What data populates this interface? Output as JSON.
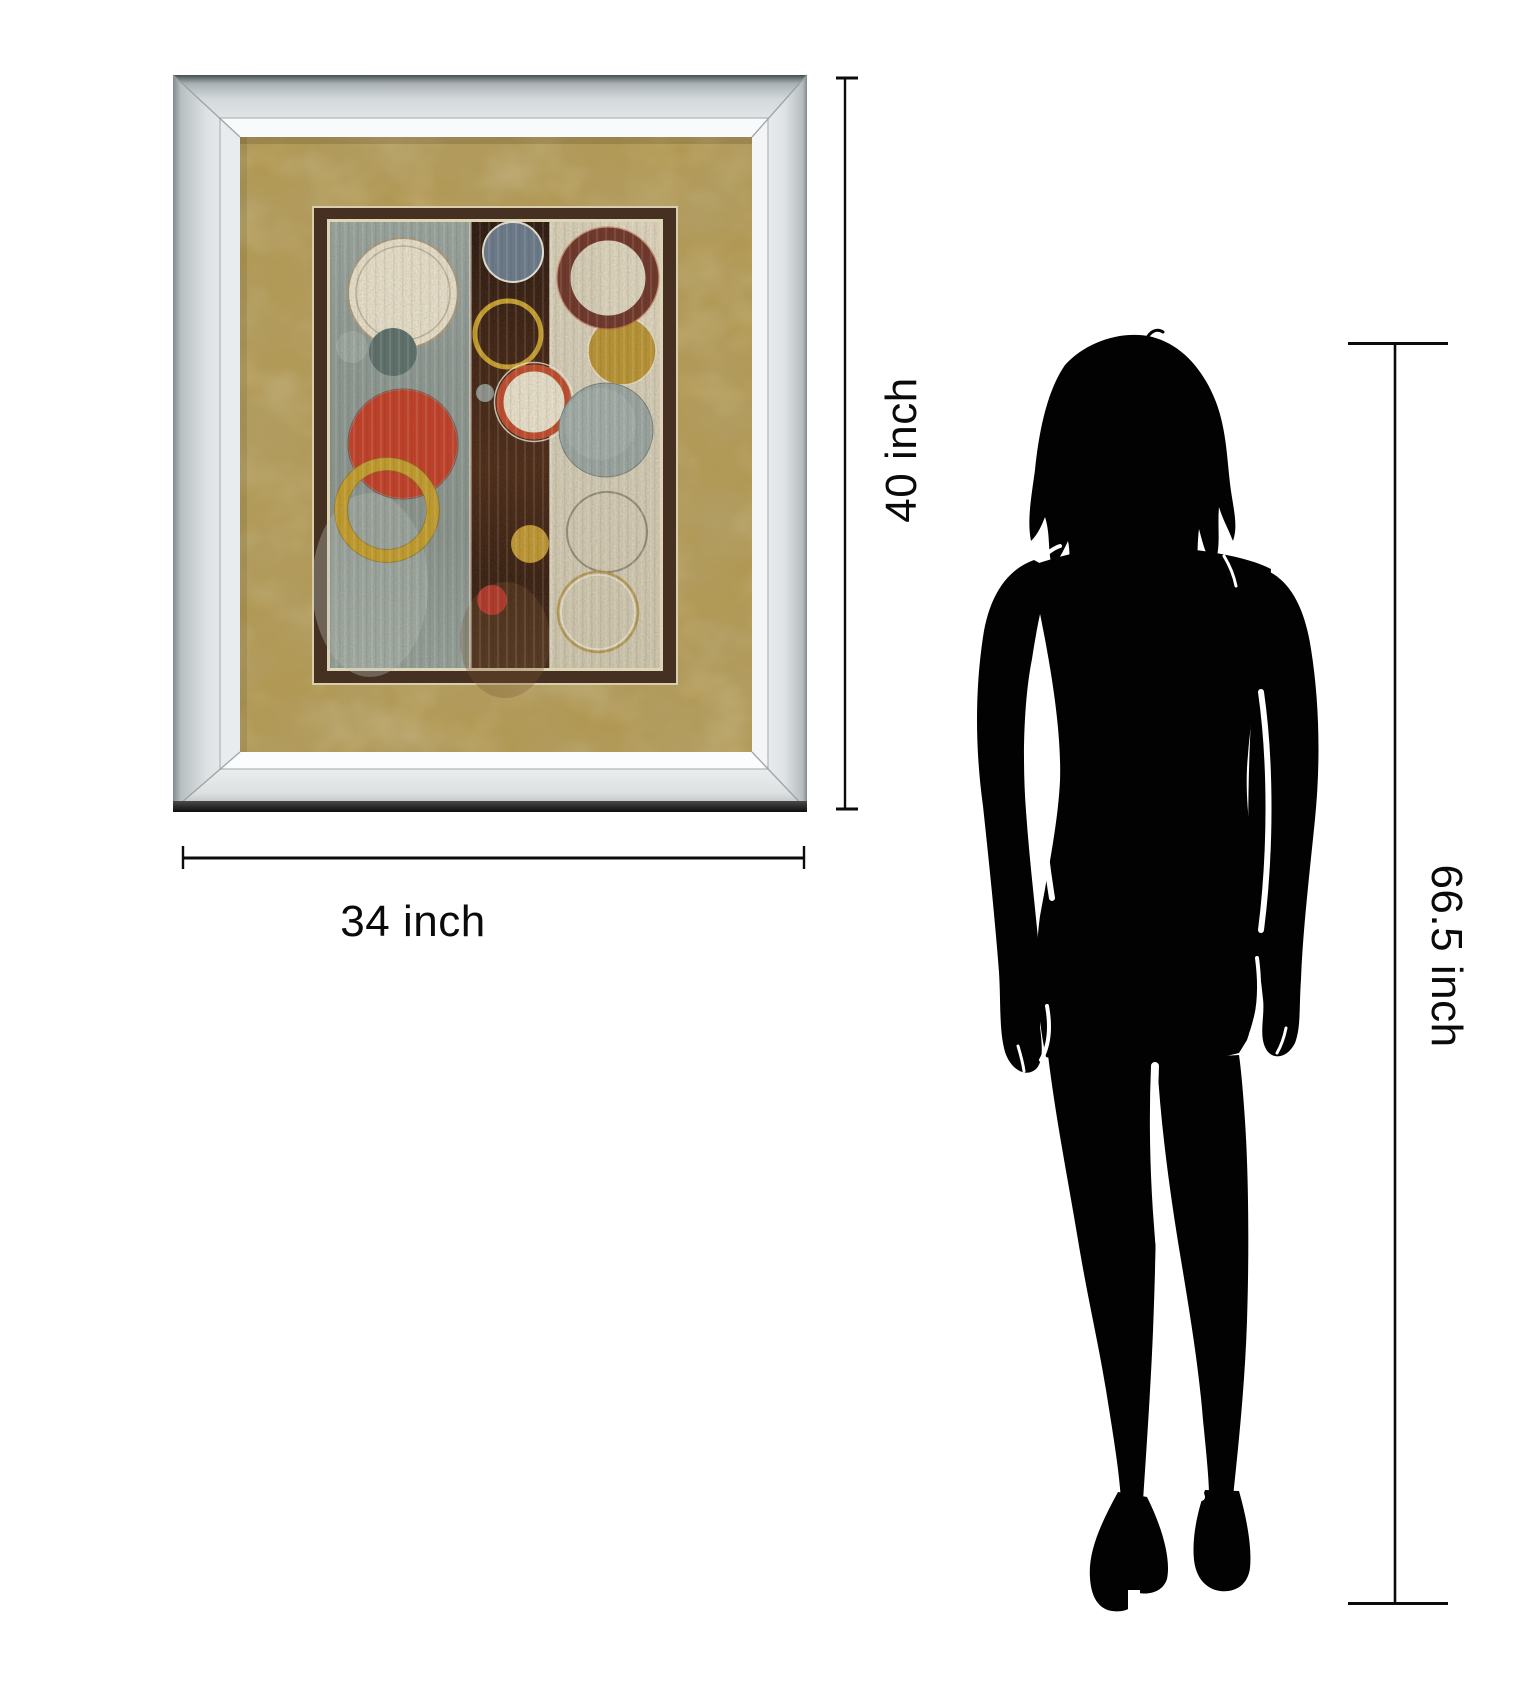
{
  "canvas": {
    "width": 1536,
    "height": 1688,
    "background": "#ffffff"
  },
  "annotations": {
    "artwork_height": {
      "label": "40 inch"
    },
    "artwork_width": {
      "label": "34 inch"
    },
    "figure_height": {
      "label": "66.5 inch"
    },
    "line_color": "#0b0b0b",
    "text_color": "#0a0a0a"
  },
  "framed_art": {
    "frame": {
      "style": "mirrored-bevel-silver",
      "face_color": "#e9ecee",
      "edge_dark": "#454d50"
    },
    "mat": {
      "color": "#b19854",
      "texture": "suede-mottled"
    },
    "inner_mat": {
      "color": "#463021",
      "liner_color": "#ded4b6"
    },
    "painting": {
      "style": "abstract-circles-triptych-bands",
      "bands": [
        {
          "name": "left-band",
          "color": "#8f9a94"
        },
        {
          "name": "middle-band",
          "color": "#3c2213"
        },
        {
          "name": "right-band",
          "color": "#d5cdb6"
        }
      ],
      "circles": [
        {
          "name": "ivory-circle-large",
          "cx": 403,
          "cy": 293,
          "r": 55,
          "fill": "#e7dfc9",
          "stroke": "#a99a7e",
          "sw": 2
        },
        {
          "name": "ivory-circle-inner-line",
          "cx": 403,
          "cy": 293,
          "r": 47,
          "fill": "none",
          "stroke": "#b6a78b",
          "sw": 1.5,
          "op": 0.8
        },
        {
          "name": "faint-gray-circle",
          "cx": 352,
          "cy": 347,
          "r": 16,
          "fill": "#a9b3ac",
          "op": 0.55
        },
        {
          "name": "slate-circle",
          "cx": 393,
          "cy": 352,
          "r": 24,
          "fill": "#5d706c"
        },
        {
          "name": "red-circle-large",
          "cx": 403,
          "cy": 444,
          "r": 54,
          "fill": "#c33f27"
        },
        {
          "name": "red-circle-rim",
          "cx": 403,
          "cy": 444,
          "r": 55,
          "fill": "none",
          "stroke": "#8d2c1c",
          "sw": 1.2,
          "op": 0.6
        },
        {
          "name": "gold-ring-left",
          "cx": 387,
          "cy": 510,
          "r": 46,
          "fill": "none",
          "stroke": "#c39d2b",
          "sw": 13
        },
        {
          "name": "gold-ring-left-outer-edge",
          "cx": 387,
          "cy": 510,
          "r": 52.5,
          "fill": "none",
          "stroke": "#7c6218",
          "sw": 1,
          "op": 0.5
        },
        {
          "name": "gold-ring-left-inner-edge",
          "cx": 387,
          "cy": 510,
          "r": 39.5,
          "fill": "none",
          "stroke": "#7c6218",
          "sw": 1,
          "op": 0.5
        },
        {
          "name": "slate-blue-circle-top",
          "cx": 513,
          "cy": 252,
          "r": 30,
          "fill": "#6b7a8b",
          "stroke": "#e9e5d6",
          "sw": 2
        },
        {
          "name": "yellow-ring-middle",
          "cx": 508,
          "cy": 334,
          "r": 33,
          "fill": "none",
          "stroke": "#c79f2d",
          "sw": 5
        },
        {
          "name": "small-gray-dot",
          "cx": 485,
          "cy": 393,
          "r": 9,
          "fill": "#8f938c"
        },
        {
          "name": "cream-circle-red-ring",
          "cx": 534,
          "cy": 402,
          "r": 34,
          "fill": "#e8e0ca",
          "stroke": "#c04b2c",
          "sw": 7
        },
        {
          "name": "cream-circle-white-halo",
          "cx": 534,
          "cy": 402,
          "r": 39.5,
          "fill": "none",
          "stroke": "#efe9d8",
          "sw": 1.5,
          "op": 0.8
        },
        {
          "name": "gold-circle-middle",
          "cx": 530,
          "cy": 544,
          "r": 19,
          "fill": "#c09732"
        },
        {
          "name": "red-circle-small",
          "cx": 492,
          "cy": 600,
          "r": 15,
          "fill": "#b23829"
        },
        {
          "name": "gold-circle-right",
          "cx": 622,
          "cy": 351,
          "r": 34,
          "fill": "#ba9433",
          "stroke": "#e6dec4",
          "sw": 1.5
        },
        {
          "name": "maroon-ring",
          "cx": 608,
          "cy": 278,
          "r": 44,
          "fill": "none",
          "stroke": "#6f3629",
          "sw": 13
        },
        {
          "name": "maroon-ring-halo",
          "cx": 608,
          "cy": 278,
          "r": 51,
          "fill": "none",
          "stroke": "#b8563a",
          "sw": 1.5,
          "op": 0.5
        },
        {
          "name": "gray-mottled-circle-large",
          "cx": 606,
          "cy": 430,
          "r": 47,
          "fill": "#9aa5a0",
          "stroke": "#75807b",
          "sw": 1
        },
        {
          "name": "gray-mottled-highlight",
          "cx": 600,
          "cy": 424,
          "r": 36,
          "fill": "#a9b3ae",
          "op": 0.6
        },
        {
          "name": "ghost-ring",
          "cx": 607,
          "cy": 532,
          "r": 40,
          "fill": "none",
          "stroke": "#847d6c",
          "sw": 2,
          "op": 0.8
        },
        {
          "name": "ghost-gold-ring",
          "cx": 598,
          "cy": 612,
          "r": 40,
          "fill": "none",
          "stroke": "#b2954a",
          "sw": 2.5,
          "op": 0.9
        },
        {
          "name": "ghost-gold-ring-highlight",
          "cx": 598,
          "cy": 612,
          "r": 37,
          "fill": "none",
          "stroke": "#f2ecd9",
          "sw": 1.5,
          "op": 0.7
        }
      ]
    }
  },
  "figure": {
    "type": "woman-silhouette",
    "color": "#020202"
  }
}
